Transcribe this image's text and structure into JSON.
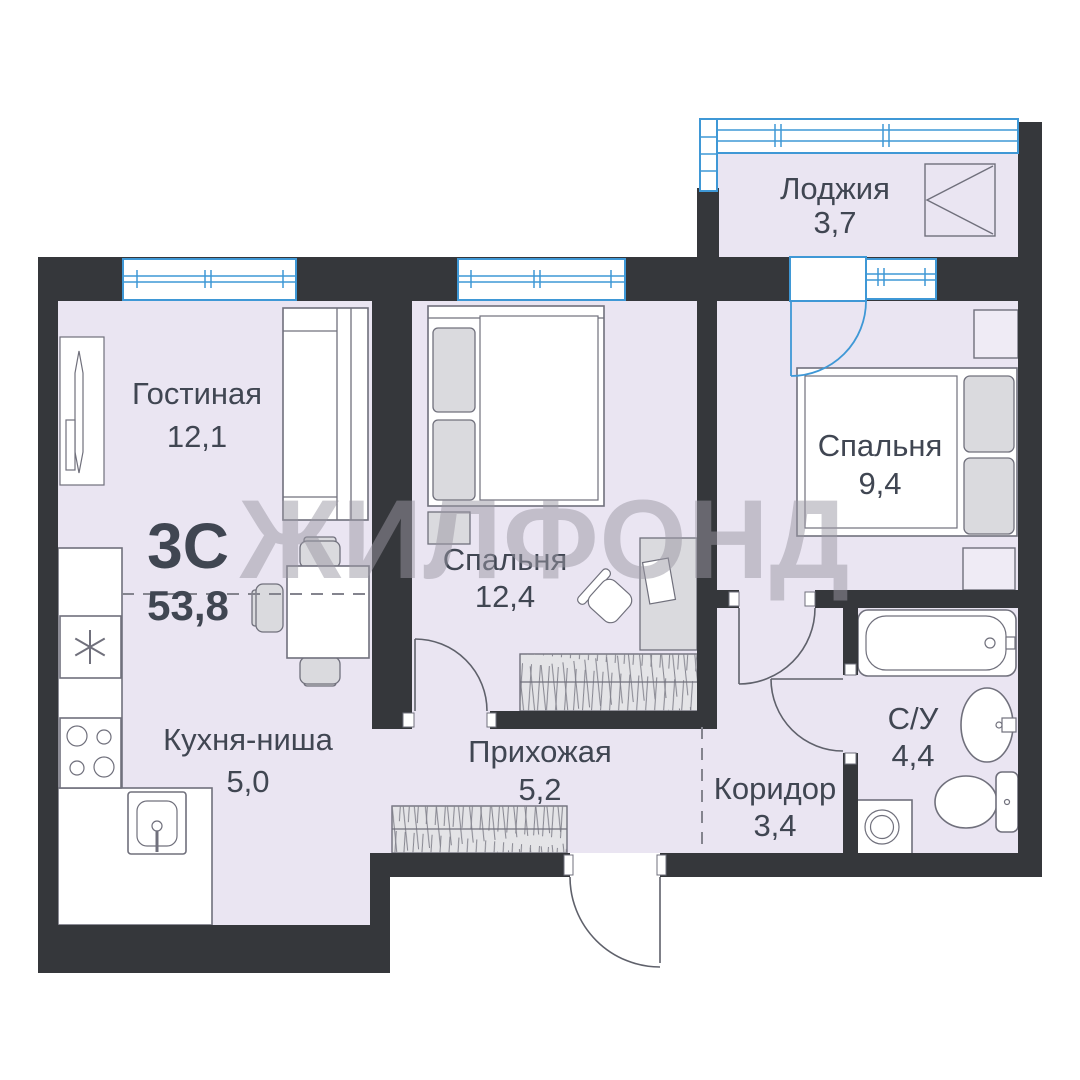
{
  "watermark": "ЖИЛФОНД",
  "plan": {
    "type_label": "3С",
    "total_area": "53,8"
  },
  "rooms": {
    "living": {
      "name": "Гостиная",
      "area": "12,1"
    },
    "bedroom1": {
      "name": "Спальня",
      "area": "12,4"
    },
    "bedroom2": {
      "name": "Спальня",
      "area": "9,4"
    },
    "loggia": {
      "name": "Лоджия",
      "area": "3,7"
    },
    "kitchen": {
      "name": "Кухня-ниша",
      "area": "5,0"
    },
    "hallway": {
      "name": "Прихожая",
      "area": "5,2"
    },
    "corridor": {
      "name": "Коридор",
      "area": "3,4"
    },
    "bathroom": {
      "name": "С/У",
      "area": "4,4"
    }
  },
  "colors": {
    "wall": "#35373b",
    "floor": "#eae5f2",
    "window": "#3f98d6",
    "furniture_outline": "#70707c",
    "text": "#404652",
    "watermark": "#9b98a4"
  }
}
